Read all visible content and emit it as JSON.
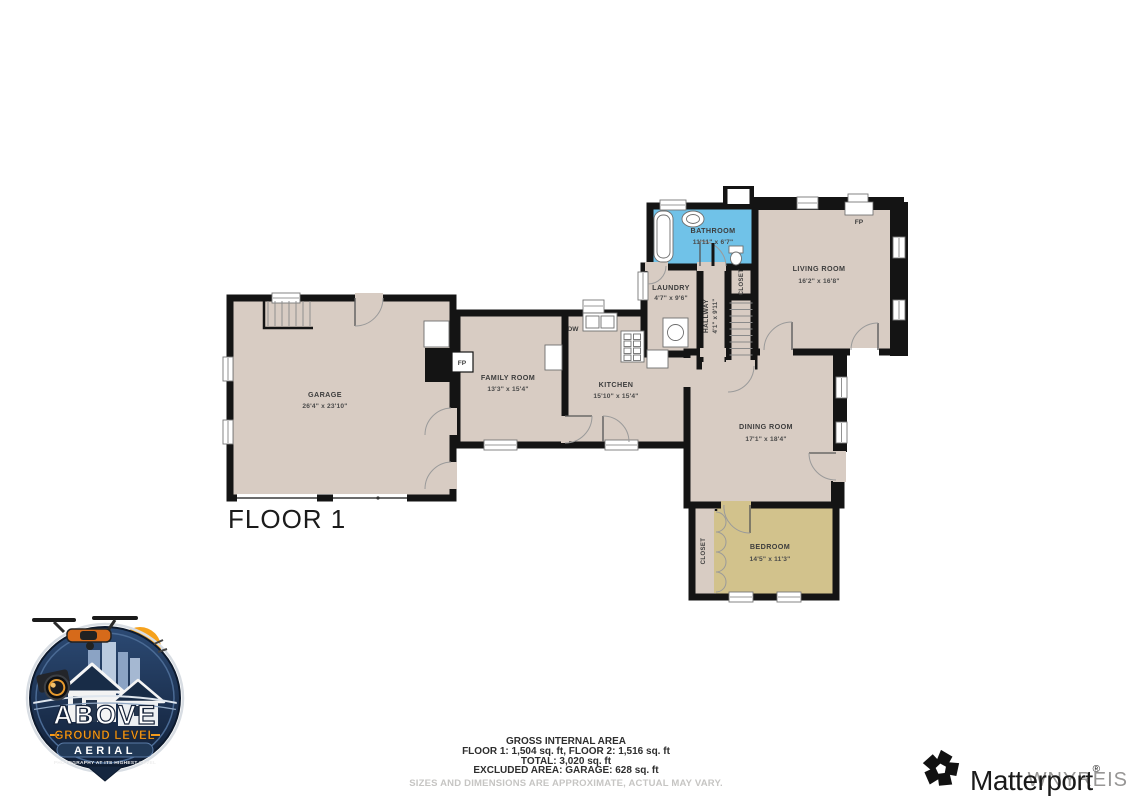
{
  "floor_label": "FLOOR 1",
  "rooms": {
    "garage": {
      "name": "GARAGE",
      "dims": "26'4\" x 23'10\""
    },
    "family_room": {
      "name": "FAMILY ROOM",
      "dims": "13'3\" x 15'4\""
    },
    "kitchen": {
      "name": "KITCHEN",
      "dims": "15'10\" x 15'4\""
    },
    "laundry": {
      "name": "LAUNDRY",
      "dims": "4'7\" x 9'6\""
    },
    "hallway": {
      "name": "HALLWAY",
      "dims": "4'1\" x 9'11\""
    },
    "closet_hall": {
      "name": "CLOSET"
    },
    "bathroom": {
      "name": "BATHROOM",
      "dims": "11'11\" x 6'7\""
    },
    "living_room": {
      "name": "LIVING ROOM",
      "dims": "16'2\" x 16'8\""
    },
    "dining_room": {
      "name": "DINING ROOM",
      "dims": "17'1\" x 18'4\""
    },
    "bedroom": {
      "name": "BEDROOM",
      "dims": "14'5\" x 11'3\""
    },
    "closet_bedroom": {
      "name": "CLOSET"
    }
  },
  "markers": {
    "fireplace": "FP",
    "dishwasher": "DW"
  },
  "area_summary": {
    "title": "GROSS INTERNAL AREA",
    "floors": "FLOOR 1: 1,504 sq. ft, FLOOR 2: 1,516 sq. ft",
    "total": "TOTAL: 3,020 sq. ft",
    "excluded": "EXCLUDED AREA: GARAGE: 628 sq. ft",
    "disclaimer": "SIZES AND DIMENSIONS ARE APPROXIMATE, ACTUAL MAY VARY."
  },
  "branding": {
    "agl_logo": {
      "word_main": "ABOVE",
      "word_sub": "GROUND LEVEL",
      "word_aerial": "AERIAL",
      "tagline": "PHOTOGRAPHY AT ITS HIGHEST LEVEL"
    },
    "matterport": {
      "wordmark": "Matterport",
      "registered": "®"
    },
    "watermark": "WNYREIS"
  },
  "colors": {
    "floor": "#d8ccc3",
    "bathroom": "#70c2e8",
    "bedroom": "#d2c28c",
    "wall": "#141414",
    "accent_orange": "#f49b1d",
    "badge_navy": "#16263f"
  }
}
